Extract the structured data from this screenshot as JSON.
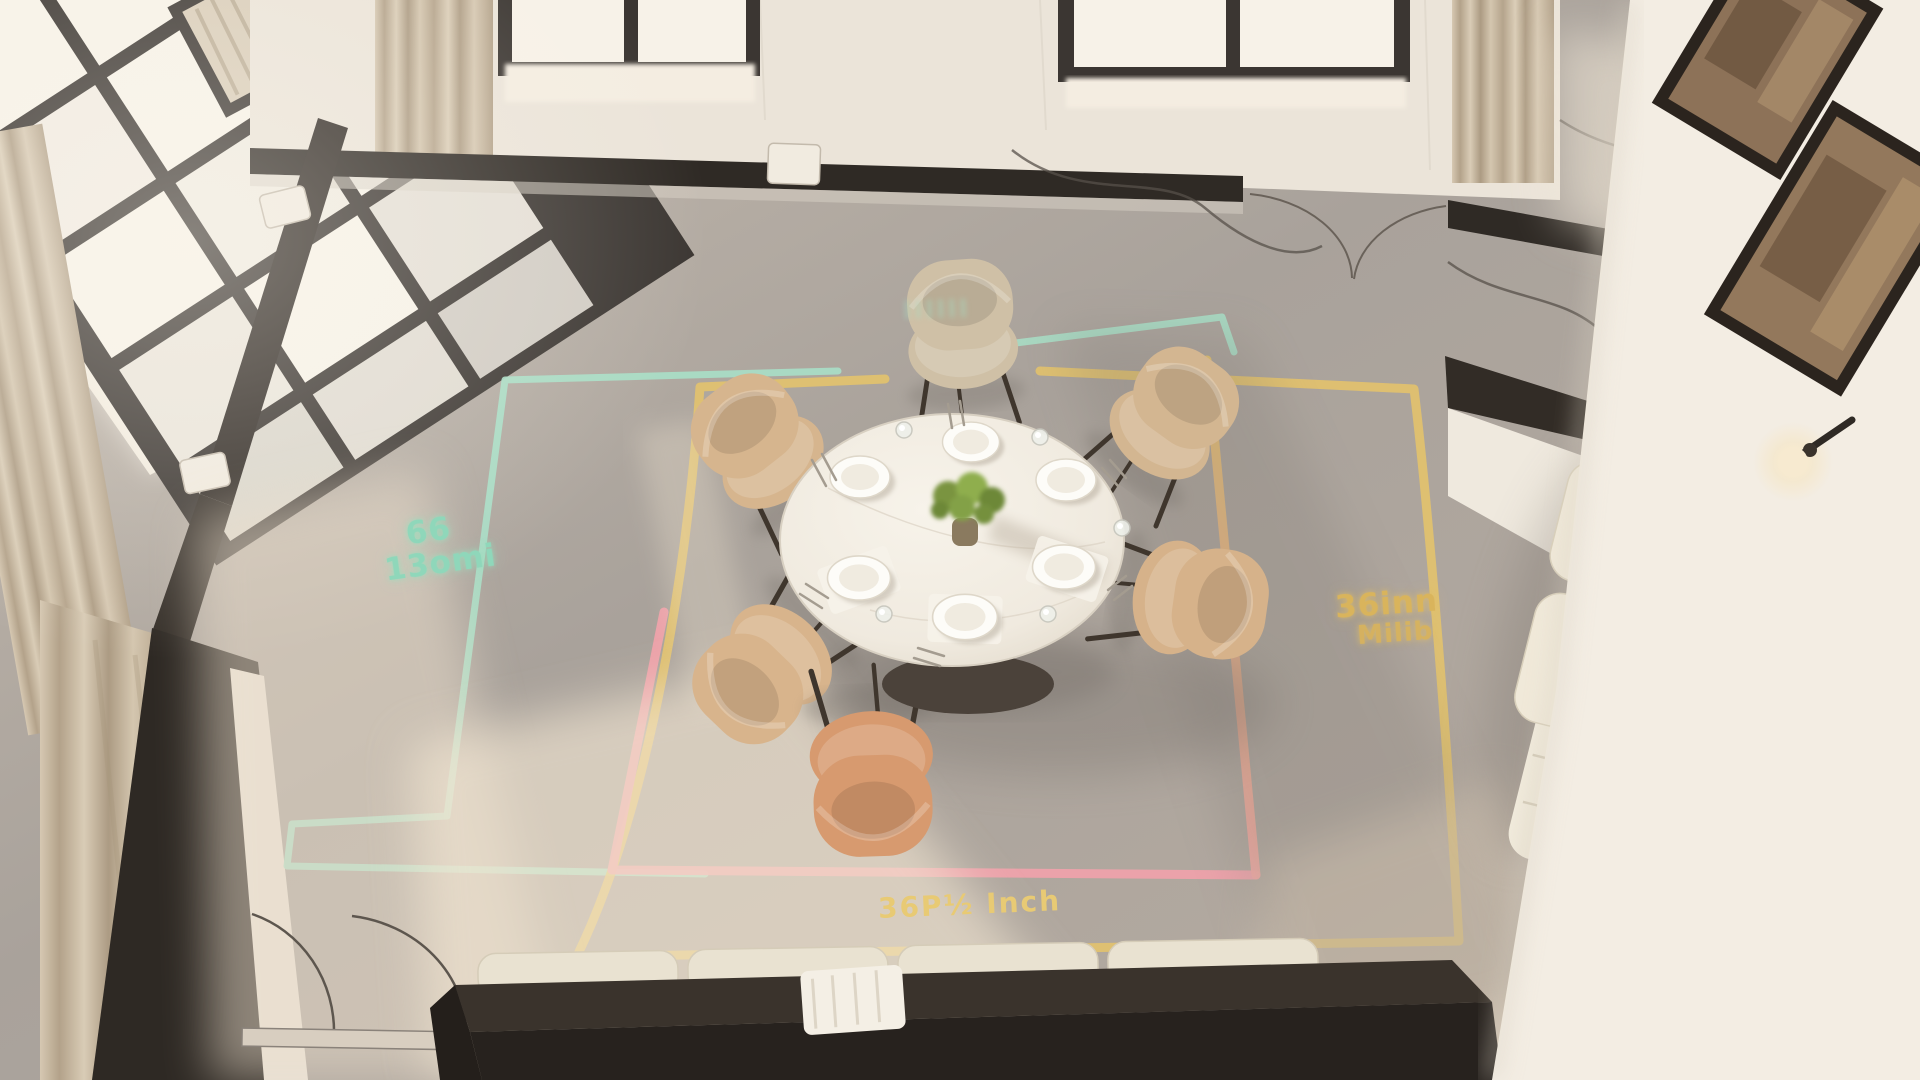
{
  "labels": {
    "left_zone": {
      "line1": "66",
      "line2": "13omi"
    },
    "top_zone": {
      "text": "llllll"
    },
    "right_zone": {
      "line1": "36inn",
      "line2": "Milib"
    },
    "bottom_zone": {
      "text": "36P½ Inch"
    }
  },
  "colors": {
    "teal_line": "#a8dfc7",
    "yellow_line": "#e6c46a",
    "pink_line": "#f2a2ab",
    "floor": "#b3aaa1",
    "wall": "#ece5da",
    "partition_dark": "#322c26",
    "window_glow": "#f7f2e8",
    "curtain": "#c9bba5",
    "table_top": "#f3eee5",
    "chair_tan": "#d5b28b",
    "chair_orange": "#d79a6f",
    "sofa_cream": "#eae3d2",
    "sconce_glow": "#f6e7c6",
    "artwork_sepia": "#8d7258"
  }
}
